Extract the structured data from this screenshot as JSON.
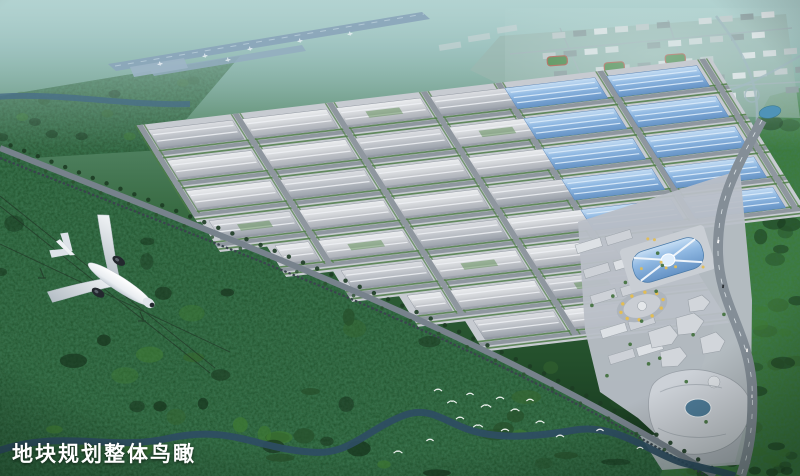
{
  "caption": {
    "text": "地块规划整体鸟瞰",
    "color": "#ffffff"
  },
  "scene": {
    "objects": [
      "airplane",
      "airport-runway",
      "industrial-park",
      "residential-district",
      "commercial-center",
      "canal",
      "river",
      "forest",
      "railway",
      "flock-of-birds"
    ]
  },
  "palette": {
    "haze": "#8fb7b6",
    "forest_dark": "#16331c",
    "forest_mid": "#2c5530",
    "forest_bright": "#3e7a33",
    "tree": "#4e7d46",
    "river": "#2e4d63",
    "canal": "#55a0b8",
    "runway": "#8ba7bb",
    "park_base": "#c7cbd1",
    "road": "#8f979f",
    "roof_light": "#dcdfe2",
    "roof_mid": "#b2b6bc",
    "roof_blue": "#8fb8e2",
    "accent_yellow": "#e3bd52",
    "residential_base": "#a8bcb8",
    "pavement": "#b9bfc7",
    "plane_white": "#f4f6f8",
    "engine_dark": "#23282e",
    "bird": "#ffffff",
    "rail": "#39444d"
  }
}
